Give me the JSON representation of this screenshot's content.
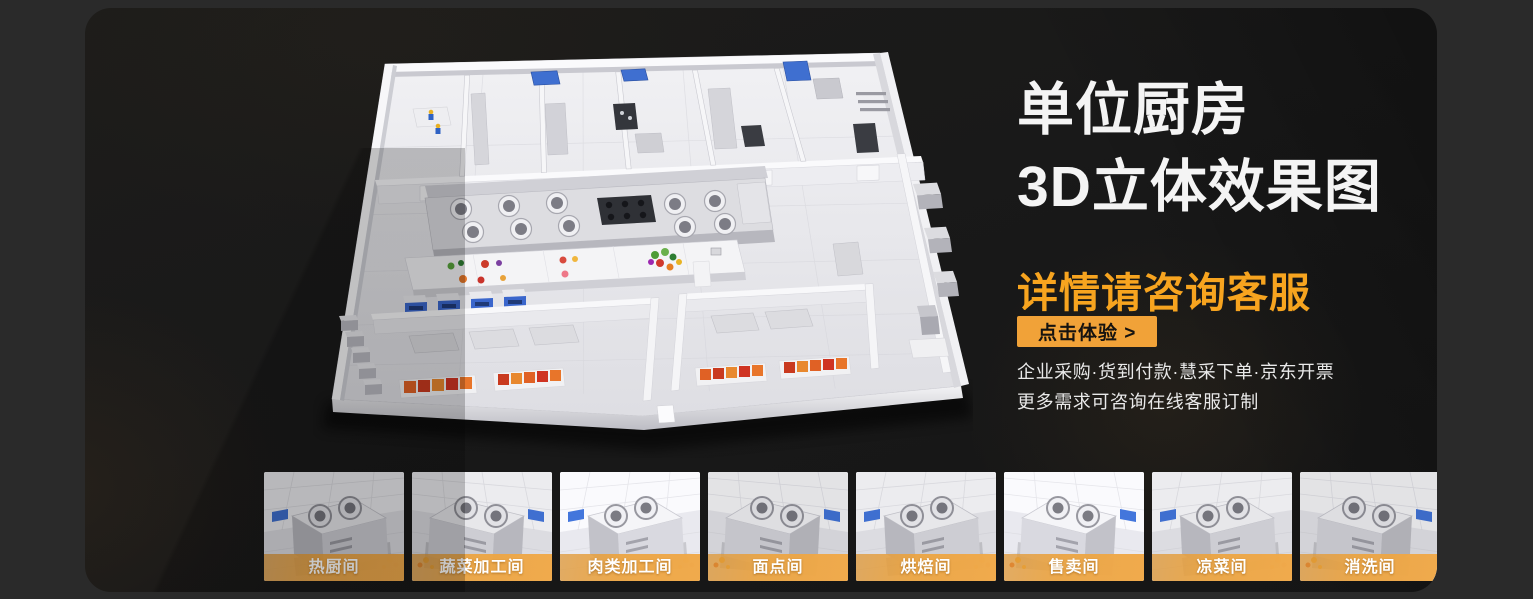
{
  "hero": {
    "title_line1": "单位厨房",
    "title_line2": "3D立体效果图",
    "subtitle": "详情请咨询客服",
    "cta_label": "点击体验 >",
    "desc_line1": "企业采购·货到付款·慧采下单·京东开票",
    "desc_line2": "更多需求可咨询在线客服订制"
  },
  "floorplan": {
    "label": "单位厨房3D立体效果图"
  },
  "thumbnails": [
    {
      "label": "热厨间"
    },
    {
      "label": "蔬菜加工间"
    },
    {
      "label": "肉类加工间"
    },
    {
      "label": "面点间"
    },
    {
      "label": "烘焙间"
    },
    {
      "label": "售卖间"
    },
    {
      "label": "凉菜间"
    },
    {
      "label": "消洗间"
    }
  ],
  "colors": {
    "accent_orange": "#F7A41F",
    "button_orange": "#F1A238",
    "thumb_label_bar": "#EDA23F",
    "title_text": "#F4F4F4",
    "body_text": "#E9E9E9",
    "panel_bg": "#1A1A1A",
    "page_bg": "#2A2A2A"
  }
}
